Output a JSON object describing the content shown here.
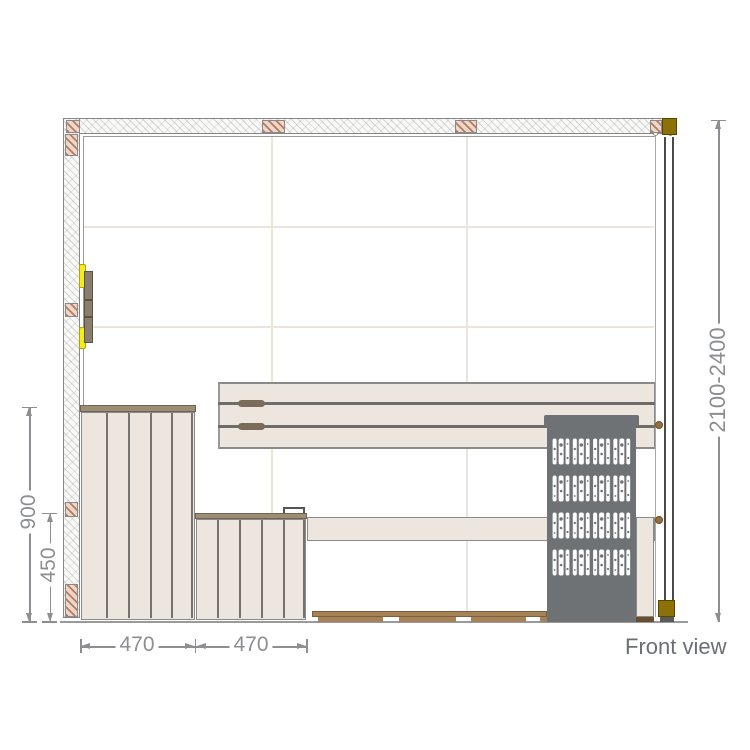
{
  "drawing": {
    "view_label": "Front view",
    "dimensions": {
      "overall_height_mm": "2100-2400",
      "backrest_bench_height_mm": "900",
      "front_bench_height_mm": "450",
      "upper_bench_depth_mm": "470",
      "lower_bench_depth_mm": "470"
    },
    "icons": [
      "wall-section-hatch-icon",
      "corner-post-icon",
      "door-hinge-icon",
      "heater-lattice-icon"
    ]
  },
  "colors": {
    "panel-line": "#ece5dc",
    "bench-fill": "#ece6de",
    "bench-outline": "#8a8a8a",
    "cap-brown": "#9d8d73",
    "handle-brown": "#7b6c5a",
    "heater-gray": "#6f7275",
    "olive": "#8c7008",
    "hinge-yellow": "#f6ec1c",
    "hinge-bar": "#8b7e6e",
    "floor-brown": "#a58257",
    "floor-dark-brown": "#6b4e2e",
    "hatch": "#b97a5e",
    "glass-line": "#4a4a4a",
    "dim-gray": "#8c8e91",
    "label-gray": "#6b6f75"
  }
}
